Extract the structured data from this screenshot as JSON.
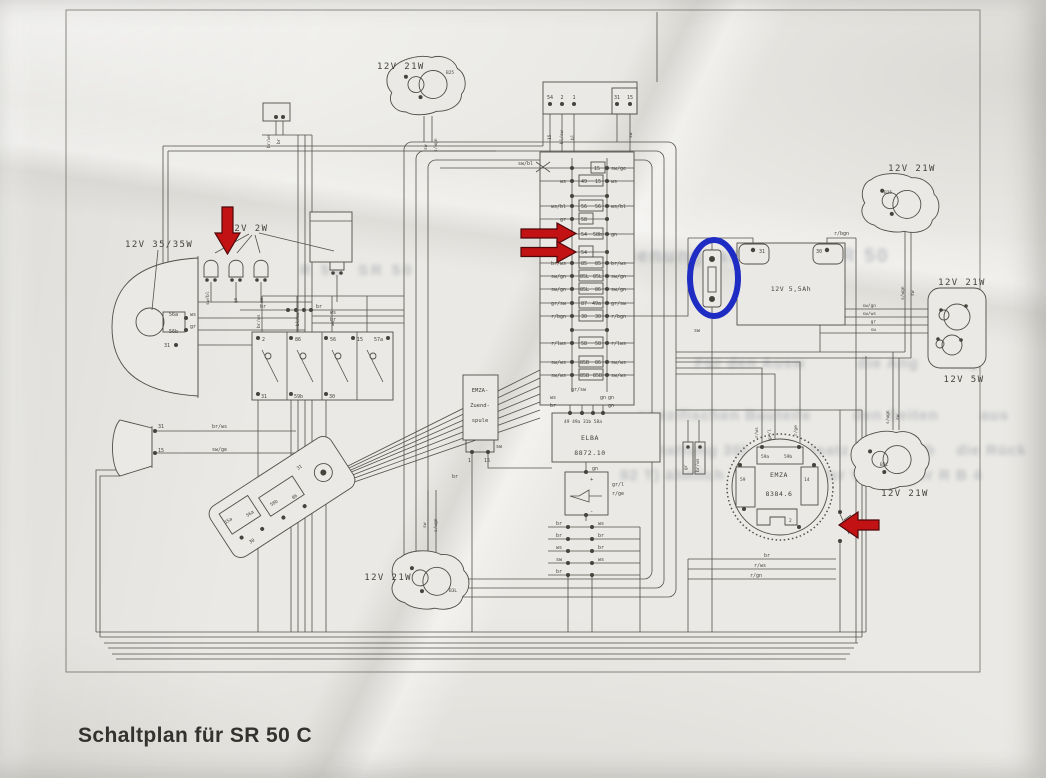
{
  "caption": "Schaltplan für SR 50 C",
  "headlight": {
    "label": "12V 35/35W",
    "t1": "56a",
    "t2": "56b",
    "t3": "31",
    "w1": "ws",
    "w2": "gr"
  },
  "pilot": {
    "label": "12V 2W",
    "w1": "sw/bl",
    "w2": "gn",
    "w3": "ws"
  },
  "horn": {
    "t1": "31",
    "t2": "15",
    "w1": "br/ws",
    "w2": "sw/ge"
  },
  "conn1": {
    "w1": "br/ws",
    "w2": "br"
  },
  "switches": {
    "t1": "2",
    "t2": "86",
    "t3": "56",
    "t4": "15",
    "t5": "57a",
    "b1": "31",
    "b2": "59b",
    "b3": "30",
    "w1": "br/ws",
    "w2": "bl/sw",
    "w3": "ws"
  },
  "lock": {
    "t1": "15a",
    "t2": "56a",
    "t3": "58b",
    "t4": "86",
    "t5": "30",
    "t6": "31"
  },
  "flasher": {
    "t1": "54",
    "t2": "2",
    "t3": "1",
    "t4": "31",
    "t5": "15",
    "w1": "15",
    "w2": "bl/sw",
    "w3": "bl",
    "w4": "sw"
  },
  "ind_fl": {
    "label": "12V 21W",
    "socket": "B25",
    "w1": "sw",
    "w2": "s/wgn"
  },
  "ind_fr": {
    "label": "12V 21W",
    "socket": "B25",
    "w1": "s/wgn",
    "w2": "sw"
  },
  "ind_rl": {
    "label": "12V 21W",
    "socket": "B3L",
    "w1": "sw",
    "w2": "s/wgn"
  },
  "ind_rr": {
    "label": "12V 21W",
    "socket": "B3L",
    "w1": "s/wgn",
    "w2": "sw"
  },
  "tail": {
    "brake": "12V 21W",
    "tail": "12V 5W",
    "w1": "sw/gn",
    "w2": "sw/ws",
    "w3": "gr",
    "w4": "sw"
  },
  "battery": {
    "label": "12V 5,5Ah",
    "t1": "31",
    "t2": "30",
    "wire": "r/bgn"
  },
  "coil": {
    "l1": "EMZA-",
    "l2": "Zuend-",
    "l3": "spule",
    "t1": "1",
    "t2": "15",
    "w1": "sw",
    "w2": "br"
  },
  "elba": {
    "l1": "ELBA",
    "l2": "8872.10",
    "terms": "49 49a 31b 58a",
    "w1": "ws",
    "w2": "br",
    "w3": "gn",
    "w4": "gn"
  },
  "rectf": {
    "plus": "+",
    "minus": "-",
    "w1": "gr/l",
    "w2": "r/ge",
    "w3": "gn"
  },
  "alt": {
    "l1": "EMZA",
    "l2": "8384.6",
    "b1": "59a",
    "b2": "59b",
    "b3": "59",
    "b4": "14",
    "b5": "2",
    "w1": "r/ws",
    "w2": "gr/l",
    "w3": "r/ge"
  },
  "conn2": {
    "w1": "gr",
    "w2": "br/ws"
  },
  "strip": {
    "top_label": "sw/bl",
    "bottom1": "gr/sw",
    "bottom2": "gn",
    "rows": [
      {
        "ll": "",
        "lt": "",
        "rt": "15",
        "rl": "sw/ge"
      },
      {
        "ll": "ws",
        "lt": "49",
        "rt": "15",
        "rl": "ws"
      },
      {
        "ll": "",
        "lt": "",
        "rt": "",
        "rl": ""
      },
      {
        "ll": "ws/bl",
        "lt": "56",
        "rt": "56",
        "rl": "ws/bl"
      },
      {
        "ll": "gr",
        "lt": "58",
        "rt": "",
        "rl": ""
      },
      {
        "ll": "",
        "lt": "54",
        "rt": "58b",
        "rl": "gn"
      },
      {
        "ll": "",
        "lt": "54",
        "rt": "",
        "rl": ""
      },
      {
        "ll": "br/ws",
        "lt": "85",
        "rt": "85",
        "rl": "br/ws"
      },
      {
        "ll": "sw/gn",
        "lt": "85L",
        "rt": "85L",
        "rl": "sw/gn"
      },
      {
        "ll": "sw/gn",
        "lt": "85L",
        "rt": "86",
        "rl": "sw/gn"
      },
      {
        "ll": "gr/sw",
        "lt": "87",
        "rt": "49a",
        "rl": "gr/sw"
      },
      {
        "ll": "r/bgn",
        "lt": "30",
        "rt": "30",
        "rl": "r/bgn"
      },
      {
        "ll": "",
        "lt": "",
        "rt": "",
        "rl": ""
      },
      {
        "ll": "r/lws",
        "lt": "58",
        "rt": "58",
        "rl": "r/lws"
      },
      {
        "ll": "sw/ws",
        "lt": "85B",
        "rt": "86",
        "rl": "sw/ws"
      },
      {
        "ll": "sw/ws",
        "lt": "85B",
        "rt": "85B",
        "rl": "sw/ws"
      }
    ]
  },
  "mini": {
    "rows": [
      {
        "l": "br",
        "r": "ws"
      },
      {
        "l": "br",
        "r": "br"
      },
      {
        "l": "ws",
        "r": "br"
      },
      {
        "l": "sw",
        "r": "ws"
      },
      {
        "l": "br",
        "r": ""
      }
    ]
  },
  "wire_labels": {
    "br1": "br",
    "br2": "br",
    "ws1": "ws",
    "br3": "br",
    "sw1": "sw",
    "brb": "br",
    "rws": "r/ws",
    "rgn": "r/gn"
  },
  "bleed": {
    "l0": "R 50  SR 50",
    "l1": "u. Bedienungsanleitung SR 50",
    "l2": "Für den Ausw          die Ang        tip",
    "l3": "spezifischen Bauteile        den Seiten        aus",
    "l4": "ausstattung 30)       rüstsatz (15 kg) üb    die Rück",
    "l5": "92 T) ähnlich      ebenso der Vorgänger R B 4",
    "l6": "R 8 4"
  }
}
